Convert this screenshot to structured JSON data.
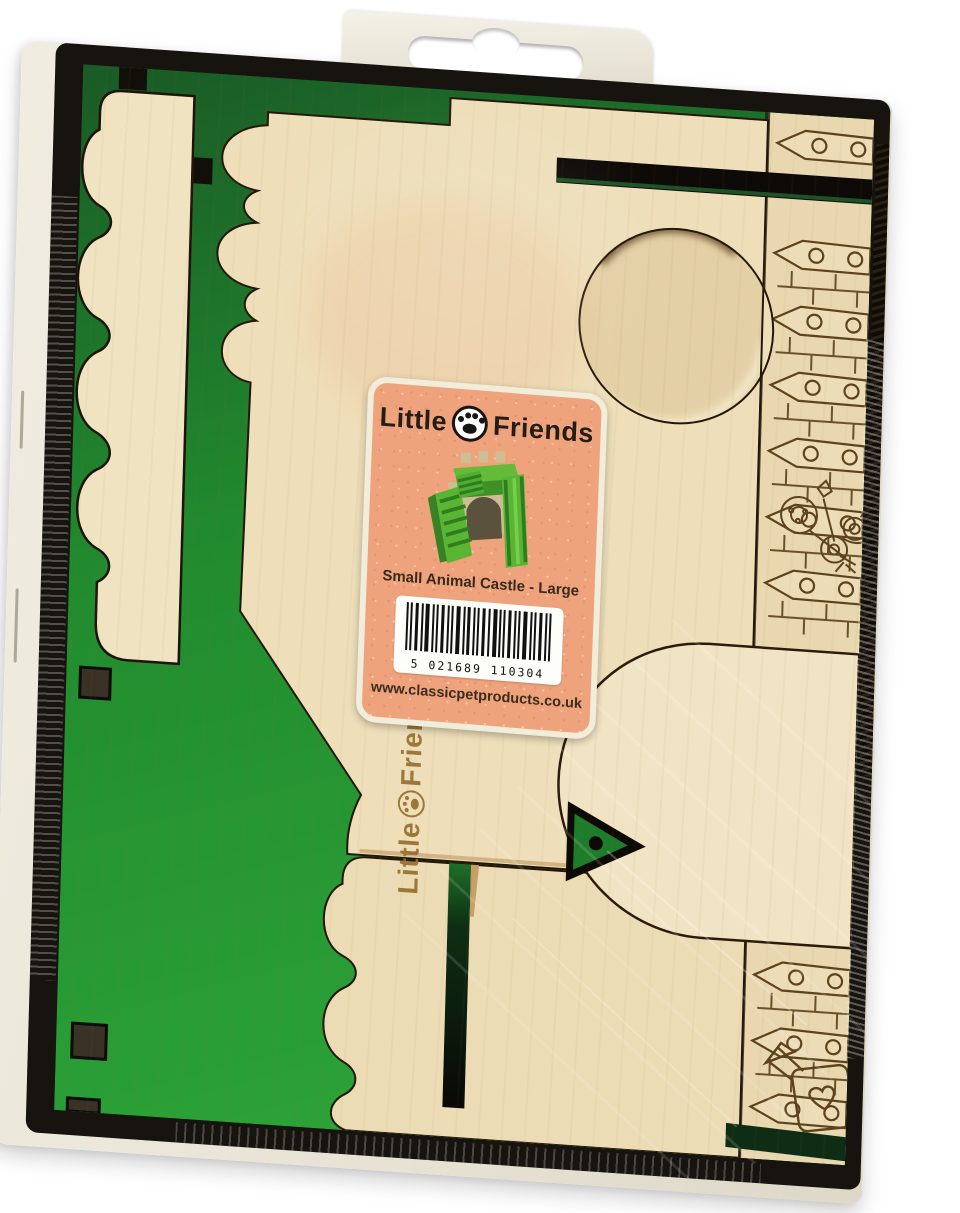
{
  "brand": {
    "first": "Little",
    "second": "Friends"
  },
  "label": {
    "product_name": "Small Animal Castle - Large",
    "barcode_digits": "5 021689 110304",
    "website": "www.classicpetproducts.co.uk"
  },
  "wood_logo": {
    "first": "Little",
    "second": "Friends"
  },
  "icons": {
    "paw_print": "paw-print-icon",
    "barcode": "barcode-graphic",
    "euro_slot": "euro-slot-hanger-hole",
    "flower_snail": "flower-and-snail-engraving",
    "watering_can": "watering-can-engraving"
  },
  "colors": {
    "plywood": "#eedfba",
    "plywood_light": "#f1e4c4",
    "green_paint": "#279632",
    "green_dark": "#1b6128",
    "label_salmon": "#efa37d",
    "engraving_brown": "#5c431d",
    "frame_black": "#17130e",
    "box_cream": "#ece7da",
    "burn_brown": "#96702d"
  }
}
